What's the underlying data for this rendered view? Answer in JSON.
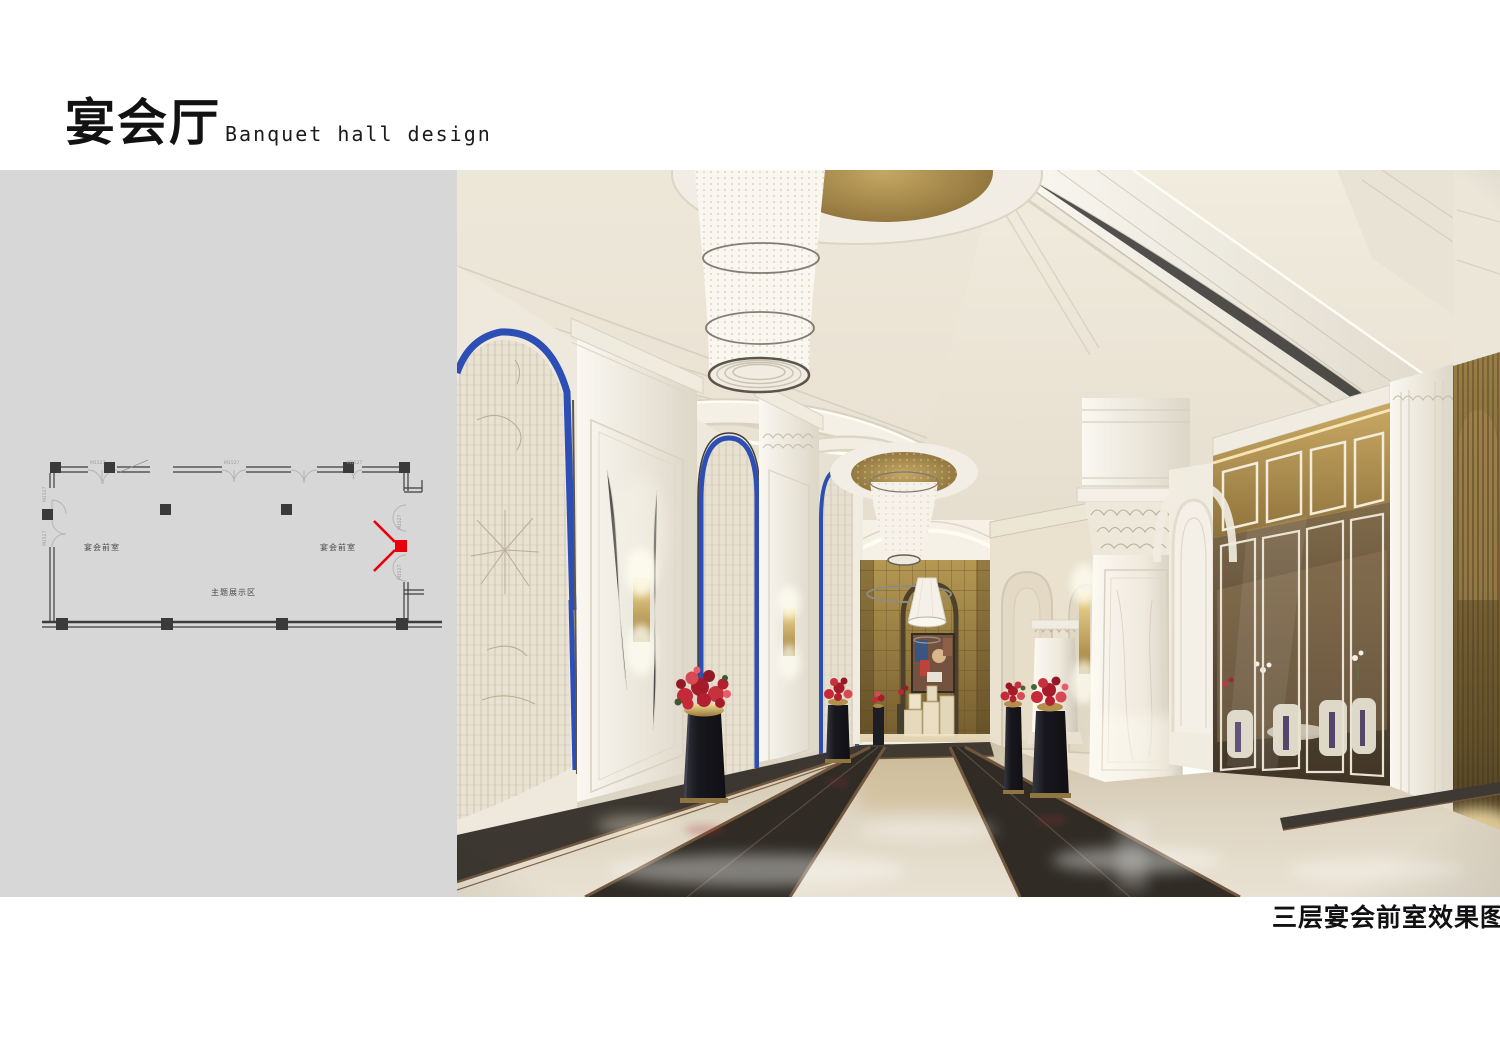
{
  "header": {
    "title_cn": "宴会厅",
    "title_en": "Banquet hall design"
  },
  "caption": "三层宴会前室效果图",
  "floor_plan": {
    "door_code": "M1527",
    "rooms": [
      {
        "label": "宴会前室"
      },
      {
        "label": "宴会前室"
      },
      {
        "label": "主题展示区"
      }
    ],
    "marker_color": "#e8000b",
    "panel_color": "#d7d7d8"
  },
  "palette": {
    "marble_white": "#f3eee5",
    "ceiling_cream": "#ece5d6",
    "accent_gold": "#a8893f",
    "accent_blue": "#2246b4",
    "floor_beige": "#d8cdb8",
    "inlay_dark": "#26221c",
    "flower_red": "#c41f2f",
    "plinth_black": "#0d0d14"
  }
}
